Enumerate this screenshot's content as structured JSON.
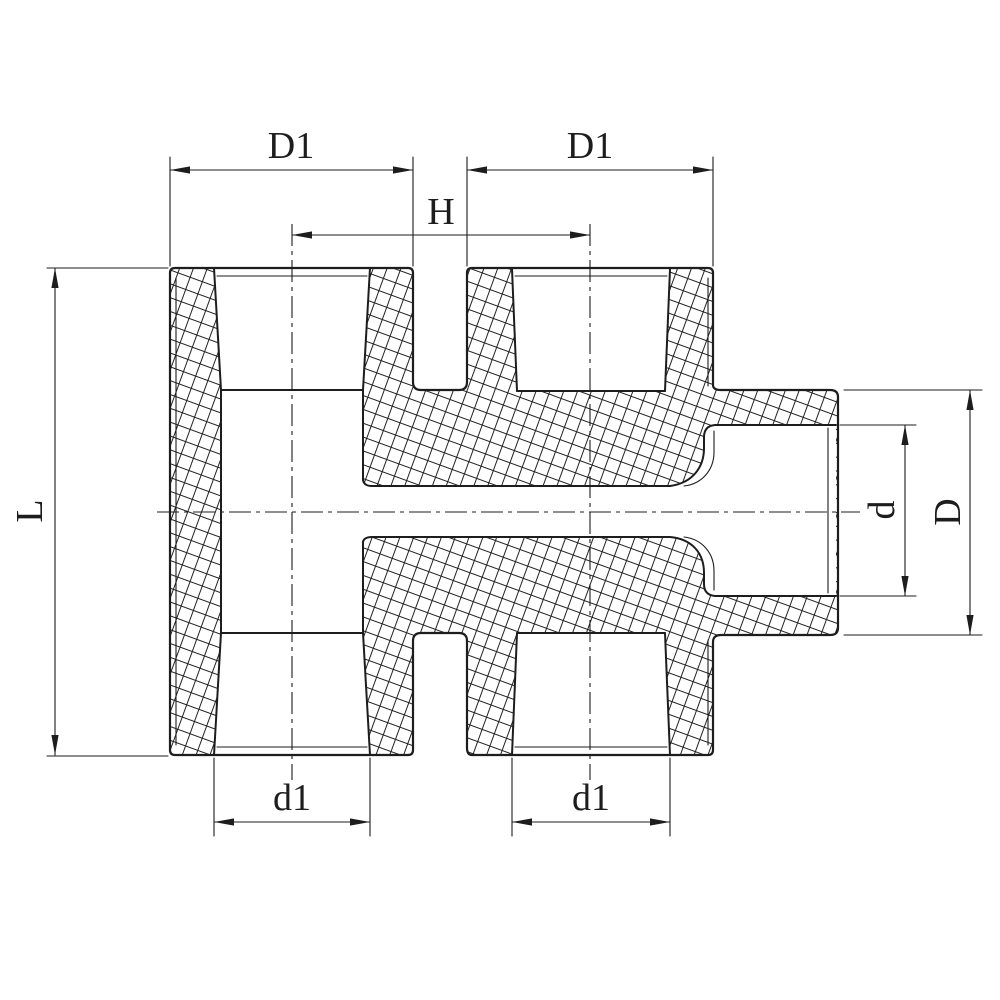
{
  "diagram": {
    "type": "engineering-cross-section-drawing",
    "background_color": "#ffffff",
    "line_color": "#1d1d1d",
    "part": "threaded pipe fitting sectional view with two vertical female threaded ports and one lateral socket outlet",
    "dims": {
      "left_port_outer_width": "D1",
      "right_port_outer_width": "D1",
      "port_center_distance": "H",
      "overall_height": "L",
      "outlet_bore_diameter": "d",
      "outlet_outer_diameter": "D",
      "left_port_bore": "d1",
      "right_port_bore": "d1"
    }
  }
}
